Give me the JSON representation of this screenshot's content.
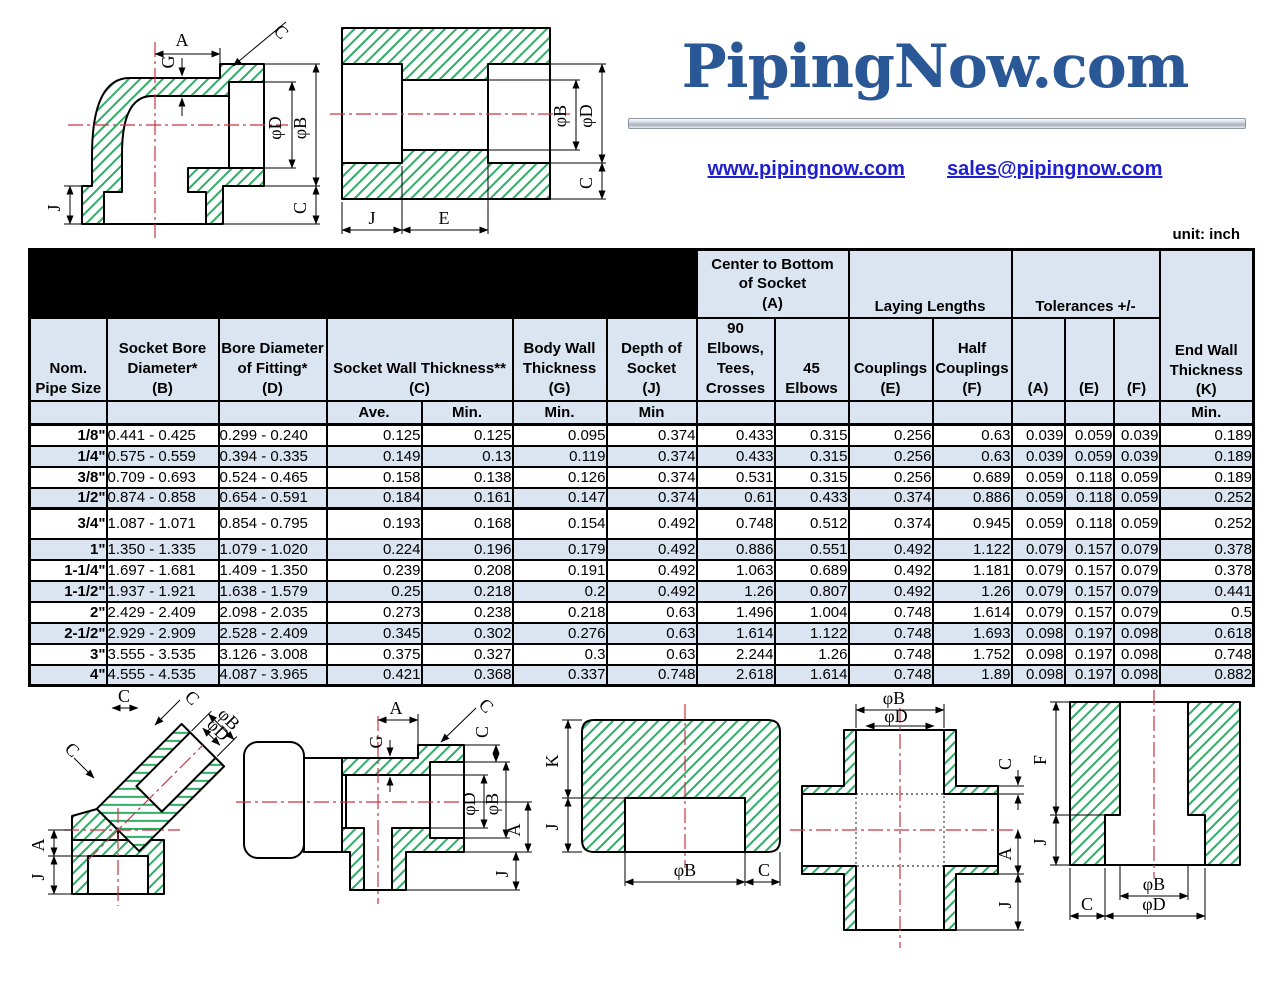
{
  "logo": {
    "brand": "PipingNow.com",
    "website": "www.pipingnow.com",
    "email": "sales@pipingnow.com",
    "brand_color": "#2a5795",
    "link_color": "#1f1fd0"
  },
  "page": {
    "unit_label": "unit: inch"
  },
  "table": {
    "title_line1": "3000# SOCKET WELD FITTING DIMENSIONS",
    "title_line2": "STAINLESS STEEL 304/304L, 316/316L  A182",
    "groups": {
      "center_a": "Center to Bottom\nof Socket\n(A)",
      "laying": "Laying Lengths",
      "tolerances": "Tolerances +/-"
    },
    "headers": {
      "nom": "Nom.\nPipe Size",
      "b": "Socket Bore\nDiameter*\n(B)",
      "d": "Bore Diameter\nof Fitting*\n(D)",
      "c": "Socket Wall Thickness**\n(C)",
      "g": "Body Wall\nThickness\n(G)",
      "j": "Depth of\nSocket\n(J)",
      "elb90": "90\nElbows,\nTees,\nCrosses",
      "elb45": "45 Elbows",
      "coupling": "Couplings\n(E)",
      "half_coupling": "Half\nCouplings\n(F)",
      "tol_a": "(A)",
      "tol_e": "(E)",
      "tol_f": "(F)",
      "k": "End Wall\nThickness\n(K)"
    },
    "subheaders": [
      "",
      "",
      "",
      "Ave.",
      "Min.",
      "Min.",
      "Min",
      "",
      "",
      "",
      "",
      "",
      "",
      "",
      "Min."
    ],
    "rows": [
      [
        "1/8\"",
        "0.441 - 0.425",
        "0.299 - 0.240",
        "0.125",
        "0.125",
        "0.095",
        "0.374",
        "0.433",
        "0.315",
        "0.256",
        "0.63",
        "0.039",
        "0.059",
        "0.039",
        "0.189"
      ],
      [
        "1/4\"",
        "0.575 - 0.559",
        "0.394 - 0.335",
        "0.149",
        "0.13",
        "0.119",
        "0.374",
        "0.433",
        "0.315",
        "0.256",
        "0.63",
        "0.039",
        "0.059",
        "0.039",
        "0.189"
      ],
      [
        "3/8\"",
        "0.709 - 0.693",
        "0.524 - 0.465",
        "0.158",
        "0.138",
        "0.126",
        "0.374",
        "0.531",
        "0.315",
        "0.256",
        "0.689",
        "0.059",
        "0.118",
        "0.059",
        "0.189"
      ],
      [
        "1/2\"",
        "0.874 - 0.858",
        "0.654 - 0.591",
        "0.184",
        "0.161",
        "0.147",
        "0.374",
        "0.61",
        "0.433",
        "0.374",
        "0.886",
        "0.059",
        "0.118",
        "0.059",
        "0.252"
      ],
      [
        "3/4\"",
        "1.087 - 1.071",
        "0.854 - 0.795",
        "0.193",
        "0.168",
        "0.154",
        "0.492",
        "0.748",
        "0.512",
        "0.374",
        "0.945",
        "0.059",
        "0.118",
        "0.059",
        "0.252"
      ],
      [
        "1\"",
        "1.350 - 1.335",
        "1.079 - 1.020",
        "0.224",
        "0.196",
        "0.179",
        "0.492",
        "0.886",
        "0.551",
        "0.492",
        "1.122",
        "0.079",
        "0.157",
        "0.079",
        "0.378"
      ],
      [
        "1-1/4\"",
        "1.697 - 1.681",
        "1.409 - 1.350",
        "0.239",
        "0.208",
        "0.191",
        "0.492",
        "1.063",
        "0.689",
        "0.492",
        "1.181",
        "0.079",
        "0.157",
        "0.079",
        "0.378"
      ],
      [
        "1-1/2\"",
        "1.937 - 1.921",
        "1.638 - 1.579",
        "0.25",
        "0.218",
        "0.2",
        "0.492",
        "1.26",
        "0.807",
        "0.492",
        "1.26",
        "0.079",
        "0.157",
        "0.079",
        "0.441"
      ],
      [
        "2\"",
        "2.429 - 2.409",
        "2.098 - 2.035",
        "0.273",
        "0.238",
        "0.218",
        "0.63",
        "1.496",
        "1.004",
        "0.748",
        "1.614",
        "0.079",
        "0.157",
        "0.079",
        "0.5"
      ],
      [
        "2-1/2\"",
        "2.929 - 2.909",
        "2.528 - 2.409",
        "0.345",
        "0.302",
        "0.276",
        "0.63",
        "1.614",
        "1.122",
        "0.748",
        "1.693",
        "0.098",
        "0.197",
        "0.098",
        "0.618"
      ],
      [
        "3\"",
        "3.555 - 3.535",
        "3.126 - 3.008",
        "0.375",
        "0.327",
        "0.3",
        "0.63",
        "2.244",
        "1.26",
        "0.748",
        "1.752",
        "0.098",
        "0.197",
        "0.098",
        "0.748"
      ],
      [
        "4\"",
        "4.555 - 4.535",
        "4.087 - 3.965",
        "0.421",
        "0.368",
        "0.337",
        "0.748",
        "2.618",
        "1.614",
        "0.748",
        "1.89",
        "0.098",
        "0.197",
        "0.098",
        "0.882"
      ]
    ]
  },
  "drawings": {
    "hatch_color": "#2fae68",
    "centerline_color": "#cc3344",
    "elbow90": {
      "labels": [
        "A",
        "C",
        "G",
        "φD",
        "φB",
        "J",
        "C"
      ]
    },
    "coupling": {
      "labels": [
        "φB",
        "φD",
        "C",
        "J",
        "E"
      ]
    },
    "elbow45": {
      "labels": [
        "C",
        "C",
        "φD",
        "φB",
        "C",
        "A",
        "J"
      ]
    },
    "tee": {
      "labels": [
        "A",
        "G",
        "C",
        "C",
        "φD",
        "φB",
        "A",
        "J"
      ]
    },
    "cap": {
      "labels": [
        "K",
        "J",
        "φB",
        "C"
      ]
    },
    "cross": {
      "labels": [
        "φB",
        "φD",
        "C",
        "A",
        "J"
      ]
    },
    "half_coupling": {
      "labels": [
        "F",
        "J",
        "φB",
        "φD",
        "C"
      ]
    }
  }
}
